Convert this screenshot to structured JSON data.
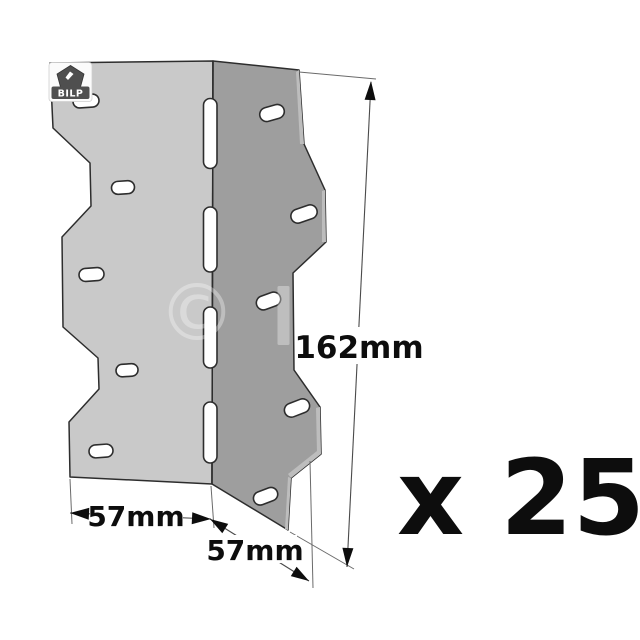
{
  "illustration": {
    "brand_badge": {
      "label": "BILP"
    },
    "watermark_symbol": "©",
    "dimension_labels": {
      "height": "162mm",
      "width_left_flange": "57mm",
      "width_right_flange": "57mm"
    },
    "quantity_label": "x 25",
    "colors": {
      "background": "#ffffff",
      "left_face": "#c9c9c9",
      "right_face": "#9e9e9e",
      "cut_edge": "#bdbdbd",
      "outline": "#2d2d2d",
      "dimension_line": "#4a4a4a",
      "text": "#0d0d0d",
      "badge": "#4f4f4f"
    }
  }
}
